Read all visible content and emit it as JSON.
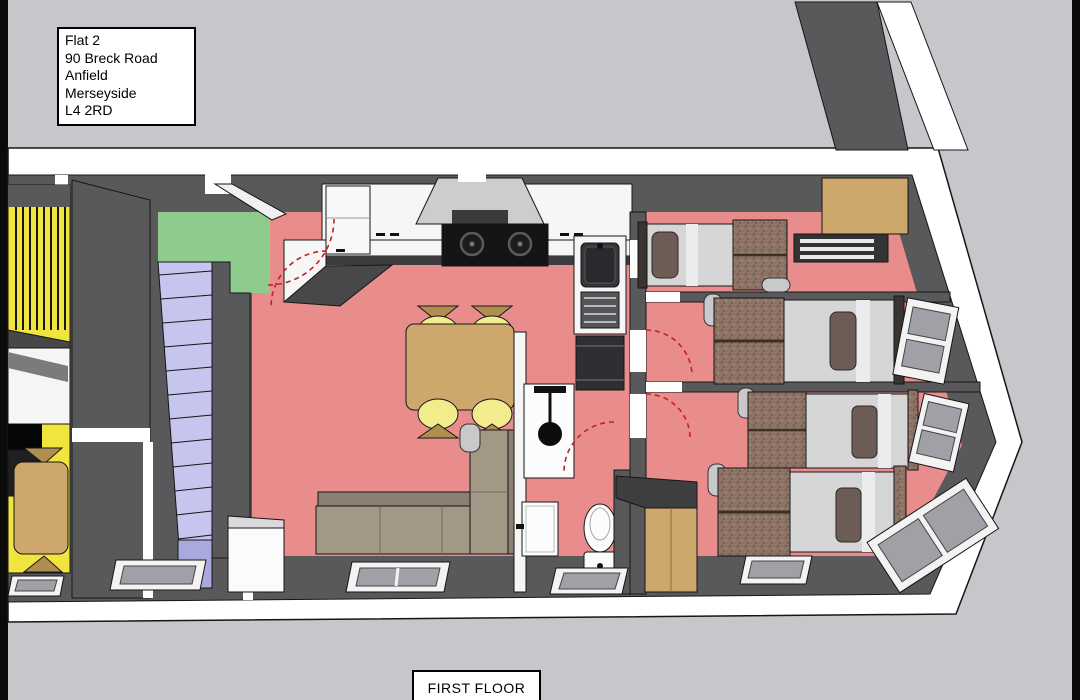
{
  "title_box": {
    "lines": [
      "Flat 2",
      "90 Breck Road",
      "Anfield",
      "Merseyside",
      "L4 2RD"
    ]
  },
  "floor_label": "FIRST FLOOR",
  "colors": {
    "bg": "#c6c6cb",
    "band": "#ffffff",
    "wall": "#59595c",
    "wallDark": "#3e3e41",
    "floor": "#e98c8c",
    "yellow": "#f0e43e",
    "green": "#8ecb8d",
    "lav": "#c5c5ee",
    "lav2": "#a9a9de",
    "wood": "#cda76c",
    "wood2": "#b08e50",
    "seat": "#f3ec8d",
    "sofa": "#a39886",
    "sofa2": "#8b8071",
    "matt": "#d6d6d7",
    "pillow": "#6d5b55",
    "glass": "#9fa1a6",
    "fabric": "#8d7365",
    "arc": "#c42222"
  }
}
